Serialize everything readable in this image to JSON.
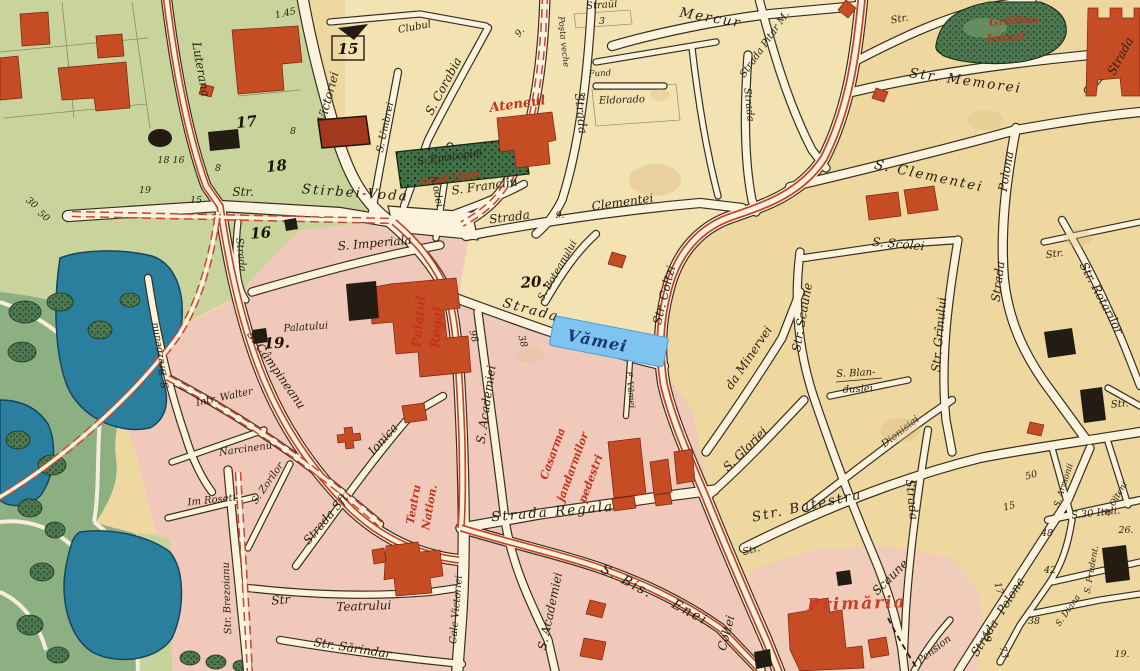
{
  "map": {
    "kind": "historic city map",
    "selection": {
      "highlighted_street_label": "Vămei"
    },
    "colors": {
      "paper_sand": "#eed8a0",
      "cream_center": "#f3e3b3",
      "olive_green": "#c9d49c",
      "district_pink": "#f1c9ba",
      "park_base": "#8db083",
      "tree_green": "#4c7950",
      "garden_green": "#47764d",
      "water_blue": "#2a7e9e",
      "street_fill": "#fcf3df",
      "street_casing": "#38301f",
      "building_red": "#c64c24",
      "building_black": "#221c12",
      "route_red": "#cc3f22",
      "label_red": "#c2341c",
      "highlight_blue": "#7fc3f1",
      "highlight_text": "#1c3576"
    },
    "labels": {
      "luterana": "Luterana",
      "victoriei_top": "Victoriei",
      "clubul": "Clubul",
      "umbrei": "S. Umbrei",
      "corabia": "S. Corabia",
      "modei": "Modei",
      "str_stirbei": "Str.",
      "stirbei_voda": "Stirbei-Voda",
      "imperiala": "S. Imperiala",
      "episcopiei": "S. Episcopiei",
      "grad_epis": "Grad Epis.",
      "ateneul": "Ateneul",
      "franclin": "S. Franclin",
      "strada_cle": "Strada",
      "clementei": "Clementei",
      "posta1": "Poşta veche",
      "posta2": "Strada",
      "fund": "Fund",
      "eldorado": "Eldorado",
      "straul": "Straûl",
      "mercur": "Mercur",
      "pitar": "Strada Pitar M.",
      "strada745": "Strada",
      "str870": "Str.",
      "gradina1": "Grădina",
      "gradina2": "Icônei",
      "memorei": "Str. Memorei",
      "clementei_e": "S. Clementei",
      "polona_n": "Polona",
      "strada_ne": "Strada",
      "scolei": "S. Şcólei",
      "str_scaune": "Str. Scaune",
      "blan1": "S. Blan-",
      "blan2": "dusiei",
      "grinului": "Str. Grînului",
      "strada1000": "Strada",
      "rotarilor": "Str. Rotarilor",
      "str1053": "Str.",
      "str1120": "Str.",
      "dionisiei": "Dionisiei",
      "strada908": "Strada",
      "scaune_s": "Scaune",
      "minervei": "da Minervei",
      "gloriei": "S. Gloriei",
      "coltzi": "Str. Coltzi",
      "coltei_s": "Coltei",
      "str748": "Str.",
      "batestra": "Str. Batestra",
      "polona_s1": "Strada",
      "polona_s2": "Polona",
      "italia": "S.30 Itali.",
      "armonii": "S. Armonii",
      "prudent": "S. Prudent.",
      "diana": "S. Diana",
      "olteni": "S. Olteni",
      "primaria": "Primăria",
      "pension": "Pension",
      "boteanului": "S. Boteanului",
      "strada_vamei": "Strada",
      "vamei": "Vămei",
      "f_vamei": "F. Vămei",
      "academiei_n": "S. Academiei",
      "academiei_s": "S. Academiei",
      "casarma1": "Casarma",
      "casarma2": "jandarmilor",
      "casarma3": "pedestri",
      "regala": "Strada Regala",
      "bis": "S. Bis.",
      "enei": "Enei",
      "teatru1": "Teatru",
      "teatru2": "Nation.",
      "str_teatr": "Str",
      "teatrului": "Teatrului",
      "sarindar": "Str. Sărindar",
      "cale_victoriei": "Cale Victoriei",
      "ionica1": "Strada Sft.",
      "ionica2": "Ionica",
      "zorilor": "S. Zorilor",
      "roseti": "Im Roseti",
      "narcinenu": "Narcinenu",
      "walter": "Intr. Walter",
      "brezoeanu": "S. Brezoeanu",
      "brezoianu": "Str. Brezoianu",
      "campineanu": "S. Câmpineanu",
      "palatului": "Palatului",
      "palatul1": "Palatul",
      "palatul2": "Regal",
      "strada240": "Strada"
    },
    "numbers": {
      "n145": "1.45",
      "n15box": "15",
      "n17": "17",
      "n18": "18",
      "n16": "16",
      "n19p": "19.",
      "n20": "20.",
      "n98": "98",
      "n38": "38",
      "n8a": "8",
      "n8b": "8",
      "n15a": "15",
      "n1816": "18 16",
      "n19a": "19",
      "n9a": "9.",
      "n9b": "9.",
      "n2a": "2",
      "n3": "3",
      "n30": "30",
      "n50b": "50",
      "n50": "50",
      "n15b": "15",
      "n48": "48",
      "n42": "42",
      "n38b": "38",
      "n17b": "17",
      "n29": "29",
      "n73": "73",
      "n26": "26.",
      "n19b": "19."
    }
  }
}
